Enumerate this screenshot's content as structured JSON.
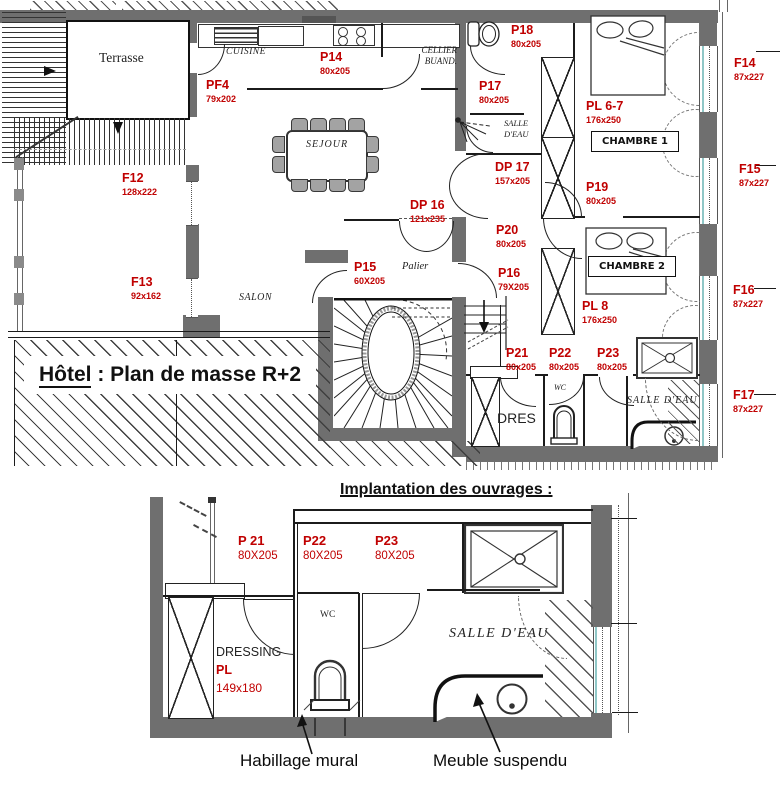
{
  "colors": {
    "red": "#c00000",
    "wall": "#6f6f6f"
  },
  "main_plan": {
    "title": {
      "prefix": "Hôtel",
      "suffix": " : Plan de masse R+2"
    },
    "rooms": {
      "terrasse": "Terrasse",
      "cuisine": "CUISINE",
      "cellier1": "CELLIER",
      "cellier2": "BUAND.",
      "sejour": "SEJOUR",
      "salon": "SALON",
      "palier": "Palier",
      "salle_eau1a": "SALLE",
      "salle_eau1b": "D'EAU",
      "wc": "WC",
      "dres": "DRES",
      "salle_eau2": "SALLE D'EAU",
      "chambre1": "CHAMBRE 1",
      "chambre2": "CHAMBRE 2"
    },
    "openings": {
      "pf4": {
        "name": "PF4",
        "size": "79x202"
      },
      "f12": {
        "name": "F12",
        "size": "128x222"
      },
      "f13": {
        "name": "F13",
        "size": "92x162"
      },
      "f14": {
        "name": "F14",
        "size": "87x227"
      },
      "f15": {
        "name": "F15",
        "size": "87x227"
      },
      "f16": {
        "name": "F16",
        "size": "87x227"
      },
      "f17": {
        "name": "F17",
        "size": "87x227"
      },
      "p14": {
        "name": "P14",
        "size": "80x205"
      },
      "p15": {
        "name": "P15",
        "size": "60X205"
      },
      "p16": {
        "name": "P16",
        "size": "79X205"
      },
      "p17": {
        "name": "P17",
        "size": "80x205"
      },
      "p18": {
        "name": "P18",
        "size": "80x205"
      },
      "p19": {
        "name": "P19",
        "size": "80x205"
      },
      "p20": {
        "name": "P20",
        "size": "80x205"
      },
      "p21": {
        "name": "P21",
        "size": "80x205"
      },
      "p22": {
        "name": "P22",
        "size": "80x205"
      },
      "p23": {
        "name": "P23",
        "size": "80x205"
      },
      "dp16": {
        "name": "DP 16",
        "size": "121x235"
      },
      "dp17": {
        "name": "DP 17",
        "size": "157x205"
      },
      "pl67": {
        "name": "PL 6-7",
        "size": "176x250"
      },
      "pl8": {
        "name": "PL 8",
        "size": "176x250"
      }
    }
  },
  "detail_plan": {
    "title": "Implantation des ouvrages :",
    "openings": {
      "p21": {
        "name": "P 21",
        "size": "80X205"
      },
      "p22": {
        "name": "P22",
        "size": "80X205"
      },
      "p23": {
        "name": "P23",
        "size": "80X205"
      },
      "pl": {
        "name": "PL",
        "size": "149x180"
      }
    },
    "rooms": {
      "wc": "WC",
      "dressing": "DRESSING",
      "salle_eau": "SALLE D'EAU"
    },
    "annotations": {
      "habillage": "Habillage mural",
      "meuble": "Meuble suspendu"
    }
  }
}
